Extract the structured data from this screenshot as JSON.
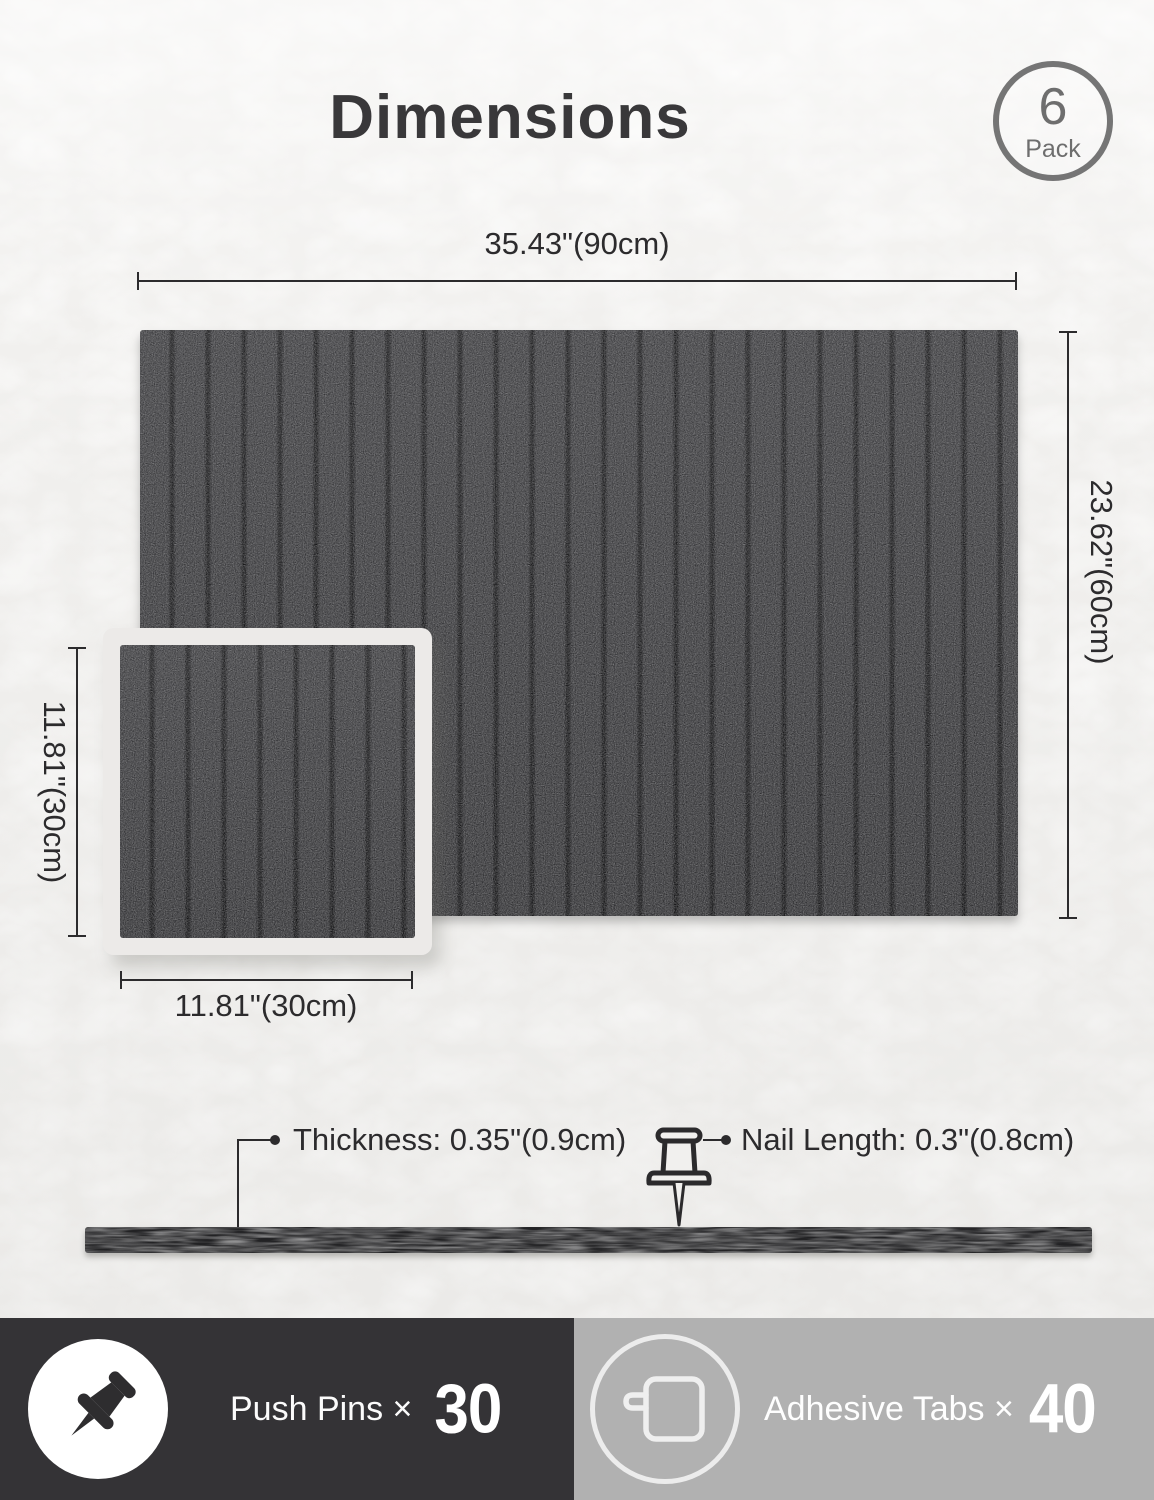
{
  "page": {
    "title": "Dimensions"
  },
  "badge": {
    "count": "6",
    "label": "Pack"
  },
  "dimensions": {
    "large_width": "35.43\"(90cm)",
    "large_height": "23.62\"(60cm)",
    "small_height": "11.81\"(30cm)",
    "small_width": "11.81\"(30cm)"
  },
  "annotations": {
    "thickness": "Thickness: 0.35\"(0.9cm)",
    "nail_length": "Nail Length: 0.3\"(0.8cm)"
  },
  "footer": {
    "push_pins_label": "Push Pins ×",
    "push_pins_count": "30",
    "adhesive_tabs_label": "Adhesive Tabs ×",
    "adhesive_tabs_count": "40"
  },
  "icons": {
    "pack_badge": "circle-badge",
    "nail": "pushpin-outline-icon",
    "push_pins": "pushpin-filled-icon",
    "adhesive_tabs": "adhesive-tab-icon"
  },
  "colors": {
    "background": "#f1f0ee",
    "panel": "#2d2d30",
    "panel_groove": "#18181a",
    "text_dark": "#2c2b2d",
    "badge_gray": "#757575",
    "footer_left_bg": "#343336",
    "footer_right_bg": "#b1b1b1",
    "footer_text": "#ffffff"
  }
}
